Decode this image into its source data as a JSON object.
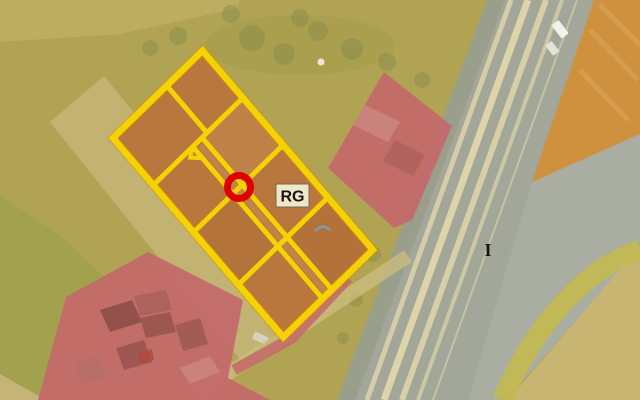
{
  "map": {
    "type": "aerial-zoning-overlay",
    "labels": [
      {
        "id": "zone-label",
        "text": "RG"
      },
      {
        "id": "road-label",
        "text": "I"
      }
    ],
    "marker": {
      "shape": "circle",
      "approx_center_x": 239,
      "approx_center_y": 187
    },
    "colors": {
      "field_olive": "#b1a354",
      "field_olive_dark": "#9da04c",
      "field_tan": "#c6b678",
      "field_tan_bright": "#c9b572",
      "field_top_light": "#c4b46a",
      "parcel_fill": "#b9773d",
      "parcel_outline": "#f5d303",
      "parcel_outline_glow": "#d98f00",
      "zone_red": "#c4686a",
      "zone_orange": "#d0913f",
      "zone_gray": "#a9ada2",
      "road_gray": "#a2a79a",
      "road_verge": "#979e87",
      "road_stripe": "#ded4a9",
      "vegetation": "#83894a",
      "embankment_green": "#c3b94f",
      "farm_road": "#ccbe80",
      "label_bg": "#f0e7c9",
      "label_border": "#6b6b5a",
      "label_text": "#141414",
      "marker_red": "#e00000"
    }
  }
}
